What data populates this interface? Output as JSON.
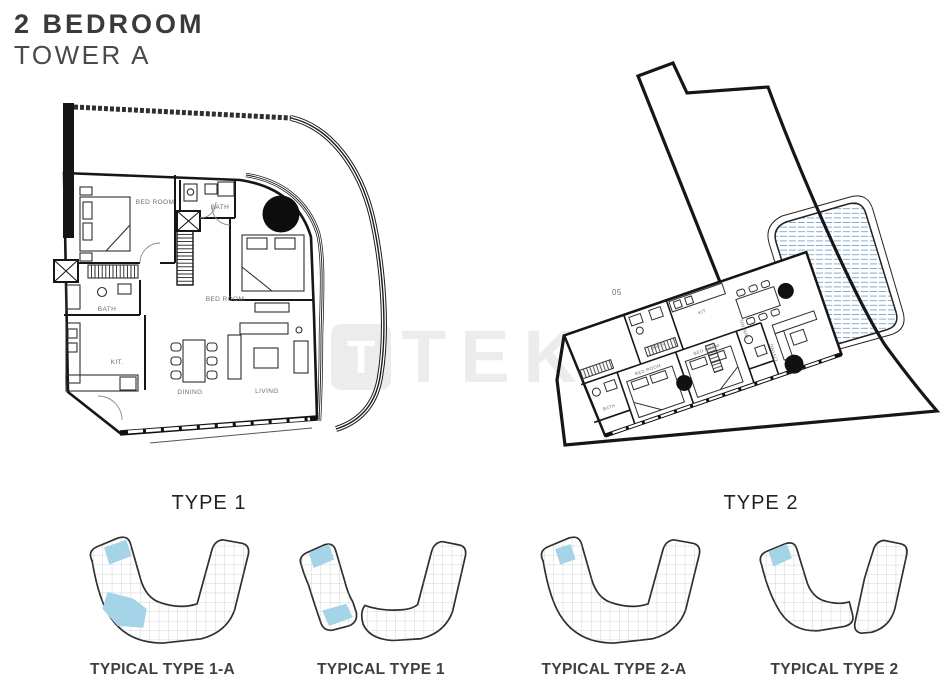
{
  "header": {
    "title": "2 BEDROOM",
    "subtitle": "TOWER A"
  },
  "watermark": {
    "logo_letter": "T",
    "text": "TEKCE"
  },
  "plan_type1": {
    "label": "TYPE 1",
    "rooms": {
      "bedroom1": "BED ROOM",
      "bath1": "BATH",
      "bedroom2": "BED ROOM",
      "bath2": "BATH",
      "kitchen": "KIT.",
      "dining": "DINING",
      "living": "LIVING"
    }
  },
  "plan_type2": {
    "label": "TYPE 2",
    "unit_number": "05",
    "rooms": {
      "bath1": "BATH",
      "kitchen": "KIT",
      "dining": "DINING",
      "bedroom1": "BED ROOM",
      "bedroom2": "BED ROOM",
      "bath2": "BATH",
      "living": "LIVING"
    }
  },
  "footprints": [
    {
      "label": "TYPICAL TYPE 1-A"
    },
    {
      "label": "TYPICAL TYPE 1"
    },
    {
      "label": "TYPICAL TYPE 2-A"
    },
    {
      "label": "TYPICAL TYPE 2"
    }
  ],
  "colors": {
    "highlight_blue": "#a5d3e8",
    "pool_hatch_blue": "#7fa6c9",
    "line_dark": "#1a1a1a",
    "watermark_gray": "#ececec",
    "label_gray": "#6e6e6e"
  }
}
